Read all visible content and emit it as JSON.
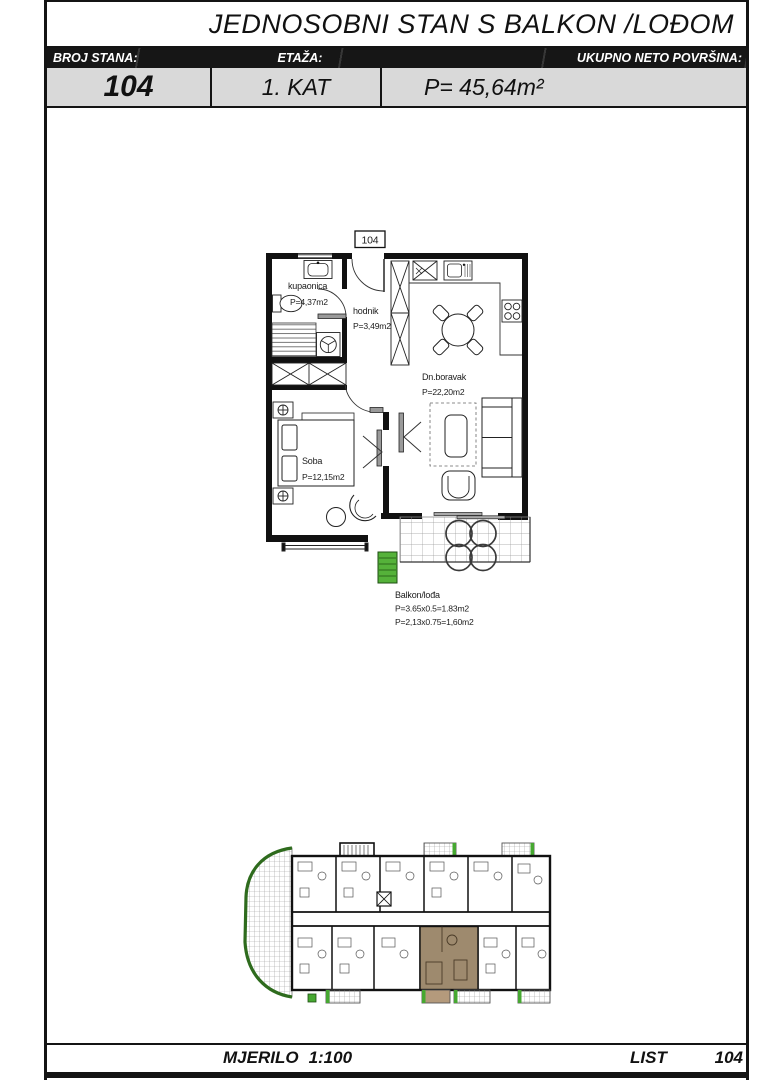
{
  "header": {
    "title": "JEDNOSOBNI STAN S BALKON /LOĐOM",
    "columns": [
      {
        "label": "BROJ STANA:",
        "value": "104"
      },
      {
        "label": "ETAŽA:",
        "value": "1. KAT"
      },
      {
        "label": "UKUPNO NETO POVRŠINA:",
        "value": "P= 45,64m²"
      }
    ]
  },
  "plan": {
    "unit_number": "104",
    "rooms": [
      {
        "name": "kupaonica",
        "area": "P=4,37m2"
      },
      {
        "name": "hodnik",
        "area": "P=3,49m2"
      },
      {
        "name": "Dn.boravak",
        "area": "P=22,20m2"
      },
      {
        "name": "Soba",
        "area": "P=12,15m2"
      }
    ],
    "balcony": {
      "name": "Balkon/lođa",
      "dim1": "P=3.65x0.5=1.83m2",
      "dim2": "P=2,13x0.75=1,60m2"
    }
  },
  "site_plan": {
    "highlighted_unit": "104"
  },
  "footer": {
    "scale_label": "MJERILO",
    "scale_value": "1:100",
    "sheet_label": "LIST",
    "sheet_number": "104"
  },
  "colors": {
    "frame_black": "#141414",
    "header_band": "#161616",
    "value_row_bg": "#d9d9d9",
    "highlight_tan": "#9e8a6e",
    "highlight_tan_light": "#b49a7c",
    "accent_green": "#46a831",
    "planter_green": "#55b23a",
    "edge_green_dark": "#2e6b1d"
  }
}
